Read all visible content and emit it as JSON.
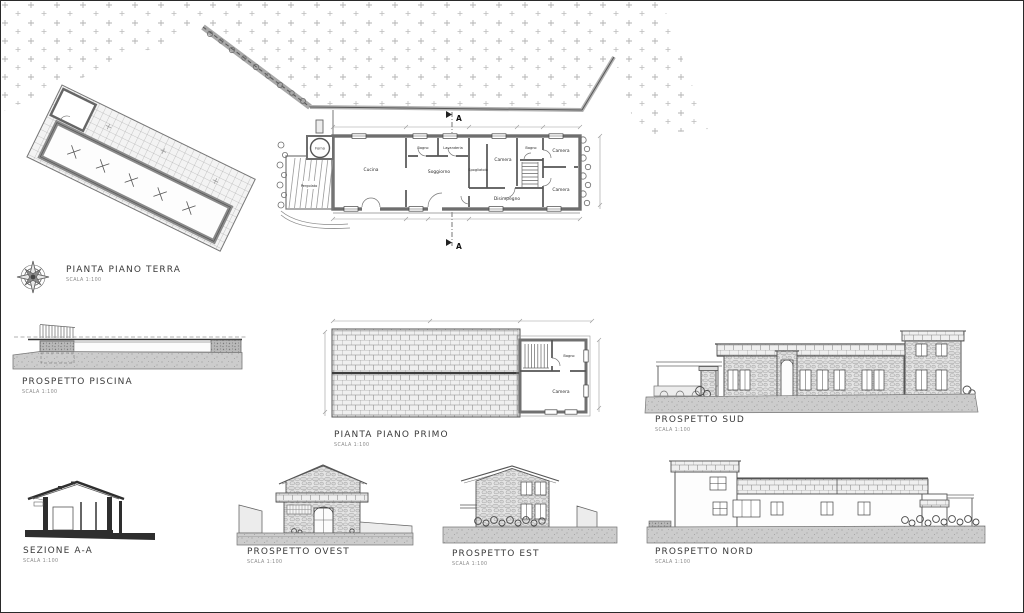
{
  "sheet": {
    "ground_floor_plan": {
      "title": "PIANTA PIANO TERRA",
      "scale": "SCALA 1:100",
      "section_marker": "A",
      "rooms": {
        "cucina": "Cucina",
        "soggiorno": "Soggiorno",
        "bagno": "Bagno",
        "lavanderia": "Lavanderia",
        "spogliatoio": "Spogliatoio",
        "camera_mid": "Camera",
        "disimpegno": "Disimpegno",
        "bagno_piccolo": "Bagno",
        "camera_nordest": "Camera",
        "camera_sudest": "Camera",
        "pergolato": "Pergolato",
        "forno": "Forno"
      }
    },
    "first_floor_plan": {
      "title": "PIANTA PIANO PRIMO",
      "scale": "SCALA 1:100",
      "rooms": {
        "camera": "Camera",
        "bagno": "Bagno"
      }
    },
    "pool_elevation": {
      "title": "PROSPETTO PISCINA",
      "scale": "SCALA 1:100"
    },
    "south_elevation": {
      "title": "PROSPETTO SUD",
      "scale": "SCALA 1:100"
    },
    "section_aa": {
      "title": "SEZIONE A-A",
      "scale": "SCALA 1:100"
    },
    "west_elevation": {
      "title": "PROSPETTO OVEST",
      "scale": "SCALA 1:100"
    },
    "east_elevation": {
      "title": "PROSPETTO EST",
      "scale": "SCALA 1:100"
    },
    "north_elevation": {
      "title": "PROSPETTO NORD",
      "scale": "SCALA 1:100"
    },
    "colors": {
      "paper": "#ffffff",
      "ink": "#3a3a3a",
      "wall": "#6e6e6e",
      "ground": "#c9c9c9",
      "field_mark": "#b3b3b3"
    }
  }
}
